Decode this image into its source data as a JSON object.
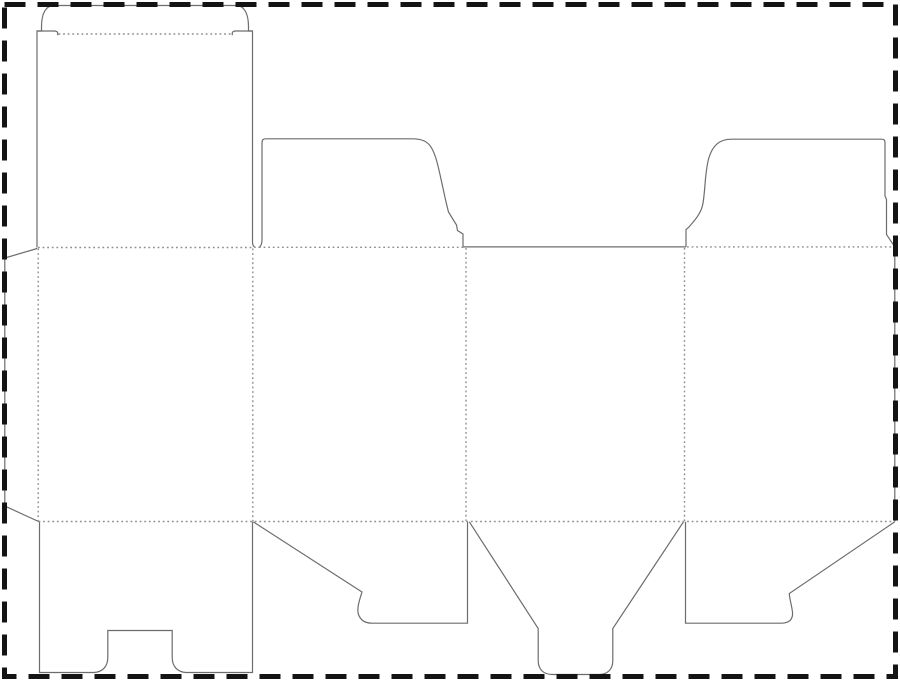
{
  "canvas": {
    "width": 900,
    "height": 681,
    "background": "#ffffff"
  },
  "styles": {
    "cut_color": "#6d6d6d",
    "fold_color": "#8f8f8f",
    "border_color": "#141414",
    "cut_width": 1.2,
    "fold_width": 1.4,
    "border_width": 5,
    "border_dash": "21 12",
    "fold_dash": "1.8 2.8"
  },
  "border": {
    "x": 4.5,
    "y": 4.5,
    "width": 891,
    "height": 672
  },
  "cuts": [
    {
      "name": "glue-flap-outline",
      "d": "M 37.2,248.5 L 4.8,258 L 4.8,506 L 38.5,521.5"
    },
    {
      "name": "lid-tuck-outline",
      "d": "M 37,247.5 L 37,31 L 41.5,31 L 41.5,27 C 41.5,13 46,5.5 54,5.5 L 236,5.5 C 244,5.5 248.5,13 248.5,27 L 248.5,31 L 252.5,31 L 252.5,241.5 C 252.5,245.6 253.6,247.1 255.6,247.5"
    },
    {
      "name": "tuck-left-hook",
      "d": "M 37,31 L 54.5,31 C 57.6,31.2 58.2,32.5 57.6,35.2"
    },
    {
      "name": "tuck-right-hook",
      "d": "M 252.5,31 L 235.5,31 C 232.4,31.2 231.8,32.5 232.4,35.2"
    },
    {
      "name": "top-dust-flap-left-outline",
      "d": "M 258.5,247.3 C 260.8,246.8 262,244 262,239 L 262,143 C 262,139.8 263,138.8 266,138.8 L 413,138.8 C 428,138.8 432.5,146 437,162 C 440.5,175 444.5,197 448.5,212 L 456.5,225 L 457.5,230.5 L 463,234 L 463,247.3"
    },
    {
      "name": "panel3-top-edge",
      "d": "M 463,246.9 L 686,246.9"
    },
    {
      "name": "top-dust-flap-right-outline",
      "d": "M 686,246.9 L 686,229.5 L 688.5,227.5 C 696,219 700.5,213.5 702.5,205.5 C 705.5,192.5 704.5,172 709,157.5 C 712.5,146 719,139.2 731.5,139.2 L 881.5,139.2 C 884.2,139.2 885,140.2 885,143 L 885,196 L 886.5,199.5 L 886.5,234.5 L 894.8,246.9"
    },
    {
      "name": "body-right-edge",
      "d": "M 894.8,246.9 L 894.8,521.5"
    },
    {
      "name": "bottom-lock-flap-outline",
      "d": "M 39.5,521.5 L 39.5,672.5 L 94,672.5 C 102.5,672 107.8,666.5 107.8,657.5 L 107.8,630.5 L 172.2,630.5 L 172.2,657.5 C 172.2,666.5 177.5,672 186,672.5 L 252.5,672.5 L 252.5,521.5"
    },
    {
      "name": "bottom-dust-flap-left-outline",
      "d": "M 253.2,521.8 L 362,592 C 359.5,600 356.5,608.5 358.5,614.5 C 360.5,620 365,623.2 372,623.2 L 467.5,623.2 L 467.5,521.8"
    },
    {
      "name": "bottom-tongue-flap-outline",
      "d": "M 469.3,521.8 L 538.2,628.5 L 538.2,660.5 C 538.2,669.5 543.5,674.5 552.5,674.5 L 598.5,674.5 C 607.5,674.5 612.8,669.5 612.8,660.5 L 612.8,628.5 L 683.5,521.8"
    },
    {
      "name": "bottom-dust-flap-right-outline",
      "d": "M 685.5,521.8 L 685.5,623.2 L 782,623.2 C 789.5,623 793,619 792.5,612.5 C 792,606 789.5,599.5 789.3,593.5 L 894.8,521.8"
    }
  ],
  "folds": [
    {
      "name": "tuck-fold",
      "d": "M 58.5,34 L 232,34"
    },
    {
      "name": "lid-top-fold",
      "d": "M 38,247.5 L 252,247.5"
    },
    {
      "name": "front-top-fold",
      "d": "M 259,247.3 L 463,247.3"
    },
    {
      "name": "back-top-fold",
      "d": "M 687,246.9 L 894.5,246.9"
    },
    {
      "name": "bottom-fold",
      "d": "M 38.5,521.5 L 894.8,521.5"
    },
    {
      "name": "glue-fold",
      "d": "M 38.2,248.5 L 38.2,521"
    },
    {
      "name": "panel-fold-1",
      "d": "M 252.8,248.5 L 252.8,521"
    },
    {
      "name": "panel-fold-2",
      "d": "M 466,248 L 466,521"
    },
    {
      "name": "panel-fold-3",
      "d": "M 684.5,248 L 684.5,521"
    }
  ]
}
